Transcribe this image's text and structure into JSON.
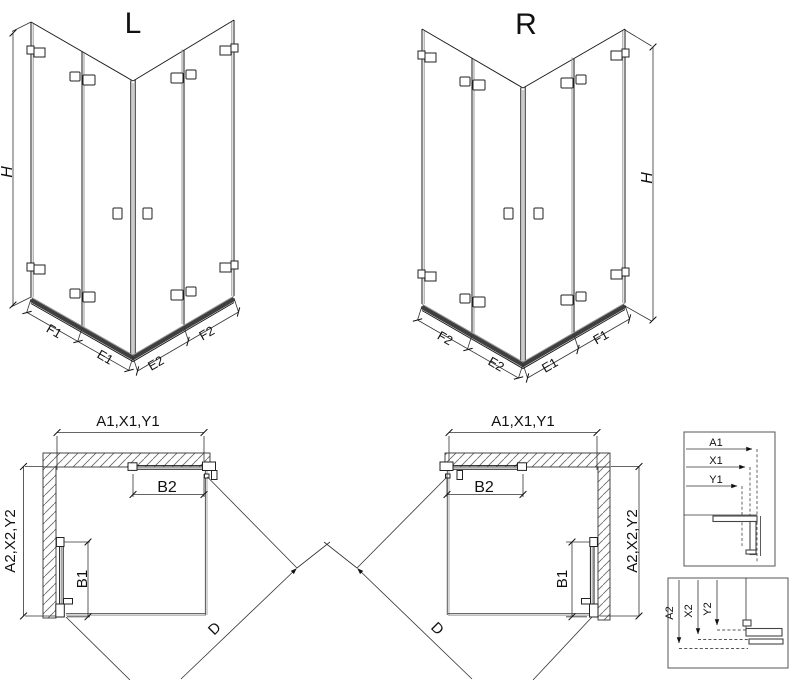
{
  "drawing": {
    "type": "shower-enclosure-technical-diagram",
    "colors": {
      "line": "#1a1a1a",
      "sill": "#3f3f3f",
      "glass": "#9a9a9a",
      "hatch": "#666",
      "background": "#ffffff"
    }
  },
  "iso_views": [
    {
      "id": "L",
      "title": "L",
      "height_label": "H",
      "bottom_edge_labels": [
        "F1",
        "E1",
        "E2",
        "F2"
      ]
    },
    {
      "id": "R",
      "title": "R",
      "height_label": "H",
      "bottom_edge_labels": [
        "F2",
        "E2",
        "E1",
        "F1"
      ]
    }
  ],
  "plan_views": [
    {
      "id": "L",
      "width_dim": "A1,X1,Y1",
      "depth_dim": "A2,X2,Y2",
      "door_width_dim": "B2",
      "door_depth_dim": "B1",
      "diagonal_dim": "D"
    },
    {
      "id": "R",
      "width_dim": "A1,X1,Y1",
      "depth_dim": "A2,X2,Y2",
      "door_width_dim": "B2",
      "door_depth_dim": "B1",
      "diagonal_dim": "D"
    }
  ],
  "detail_boxes": [
    {
      "id": "width-profile",
      "dims": [
        "A1",
        "X1",
        "Y1"
      ]
    },
    {
      "id": "depth-profile",
      "dims": [
        "A2",
        "X2",
        "Y2"
      ]
    }
  ]
}
